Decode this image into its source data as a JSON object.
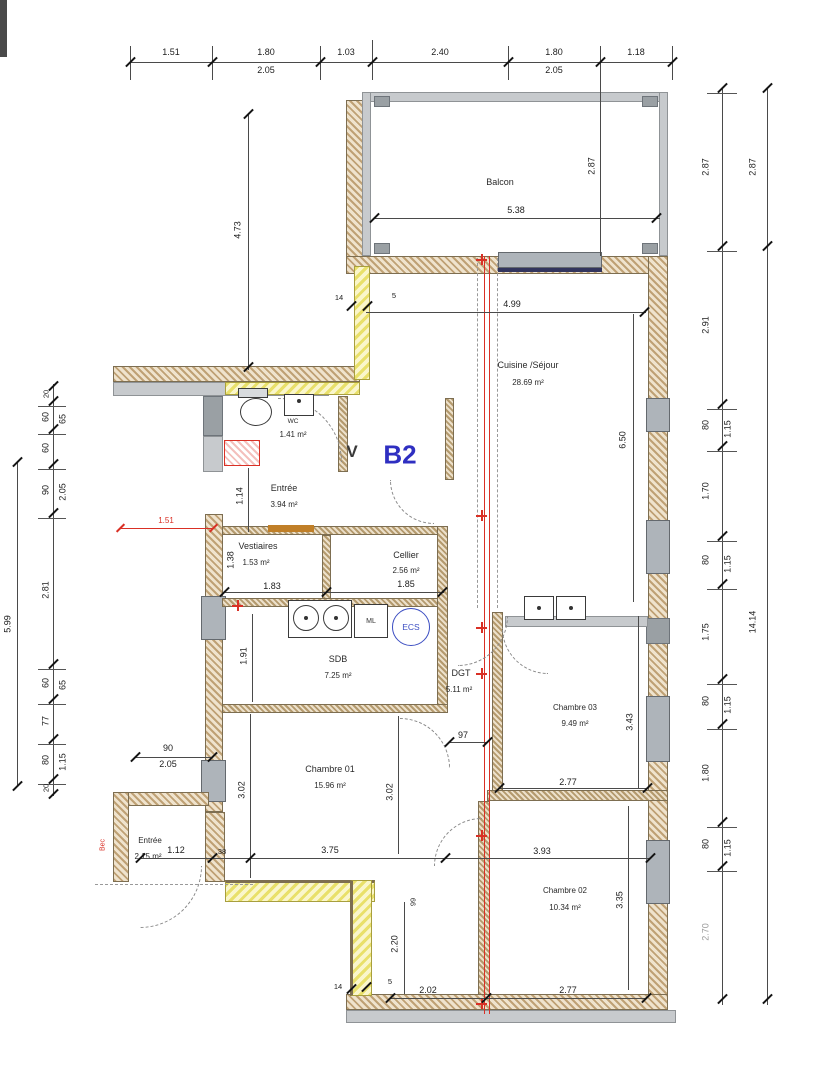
{
  "unit": {
    "check_mark": "V",
    "label": "B2"
  },
  "rooms": {
    "balcon": {
      "name": "Balcon"
    },
    "cuisine": {
      "name": "Cuisine /Séjour",
      "area": "28.69 m²"
    },
    "wc": {
      "name": "WC",
      "area": "1.41 m²"
    },
    "entree": {
      "name": "Entrée",
      "area": "3.94 m²"
    },
    "vestiaires": {
      "name": "Vestiaires",
      "area": "1.53 m²"
    },
    "cellier": {
      "name": "Cellier",
      "area": "2.56 m²"
    },
    "sdb": {
      "name": "SDB",
      "area": "7.25 m²"
    },
    "dgt": {
      "name": "DGT",
      "area": "5.11 m²"
    },
    "ch01": {
      "name": "Chambre 01",
      "area": "15.96 m²"
    },
    "ch02": {
      "name": "Chambre 02",
      "area": "10.34 m²"
    },
    "ch03": {
      "name": "Chambre 03",
      "area": "9.49 m²"
    },
    "entree_ext": {
      "name": "Entrée",
      "area": "2.15 m²"
    }
  },
  "fixtures": {
    "ml": "ML",
    "ecs": "ECS"
  },
  "annotations": {
    "bec": "Bec"
  },
  "colors": {
    "accent_red": "#d93025",
    "unit_blue": "#2f2fc1",
    "ecs_blue": "#3c4ec2",
    "insulation_yellow": "#e9e06a",
    "wall_tan": "#bfa175",
    "concrete_gray": "#c7cacd"
  },
  "dims": {
    "top": [
      "1.51",
      "1.80",
      "1.03",
      "2.40",
      "1.80",
      "1.18"
    ],
    "top_sub": [
      "2.05",
      "2.05"
    ],
    "left_outer": "5.99",
    "left": [
      "20",
      "60",
      "60",
      "90",
      "2.81",
      "60",
      "77",
      "80",
      "20"
    ],
    "left_sub": [
      "65",
      "2.05",
      "65",
      "1.15"
    ],
    "right": [
      "2.87",
      "2.91",
      "80",
      "1.70",
      "80",
      "1.75",
      "80",
      "1.80",
      "80",
      "2.70"
    ],
    "right_sub": [
      "1.15",
      "1.15",
      "1.15",
      "1.15"
    ],
    "right_outer": [
      "2.87",
      "14.14"
    ],
    "balcon_w": "5.38",
    "balcon_h": "2.87",
    "v_473": "4.73",
    "h_499": "4.99",
    "v_650": "6.50",
    "v_114": "1.14",
    "wall_14_top": "14",
    "wall_5_top": "5",
    "wall_14_bot": "14",
    "wall_5_bot": "5",
    "red_151": "1.51",
    "vest_w": "1.83",
    "vest_h": "1.38",
    "cellier_w": "1.85",
    "sdb_h": "1.91",
    "dgt_w": "97",
    "ch01_h": "3.02",
    "ch01_h2": "3.02",
    "ch01_w": "3.75",
    "left_90": "90",
    "left_205": "2.05",
    "entx_w": "1.12",
    "wall_38": "38",
    "ch02_top": "3.93",
    "ch02_h": "3.35",
    "ch02_bot": "2.77",
    "ch03_h": "3.43",
    "ch03_w": "2.77",
    "v_220": "2.20",
    "v_99": "99",
    "bot_202": "2.02"
  }
}
